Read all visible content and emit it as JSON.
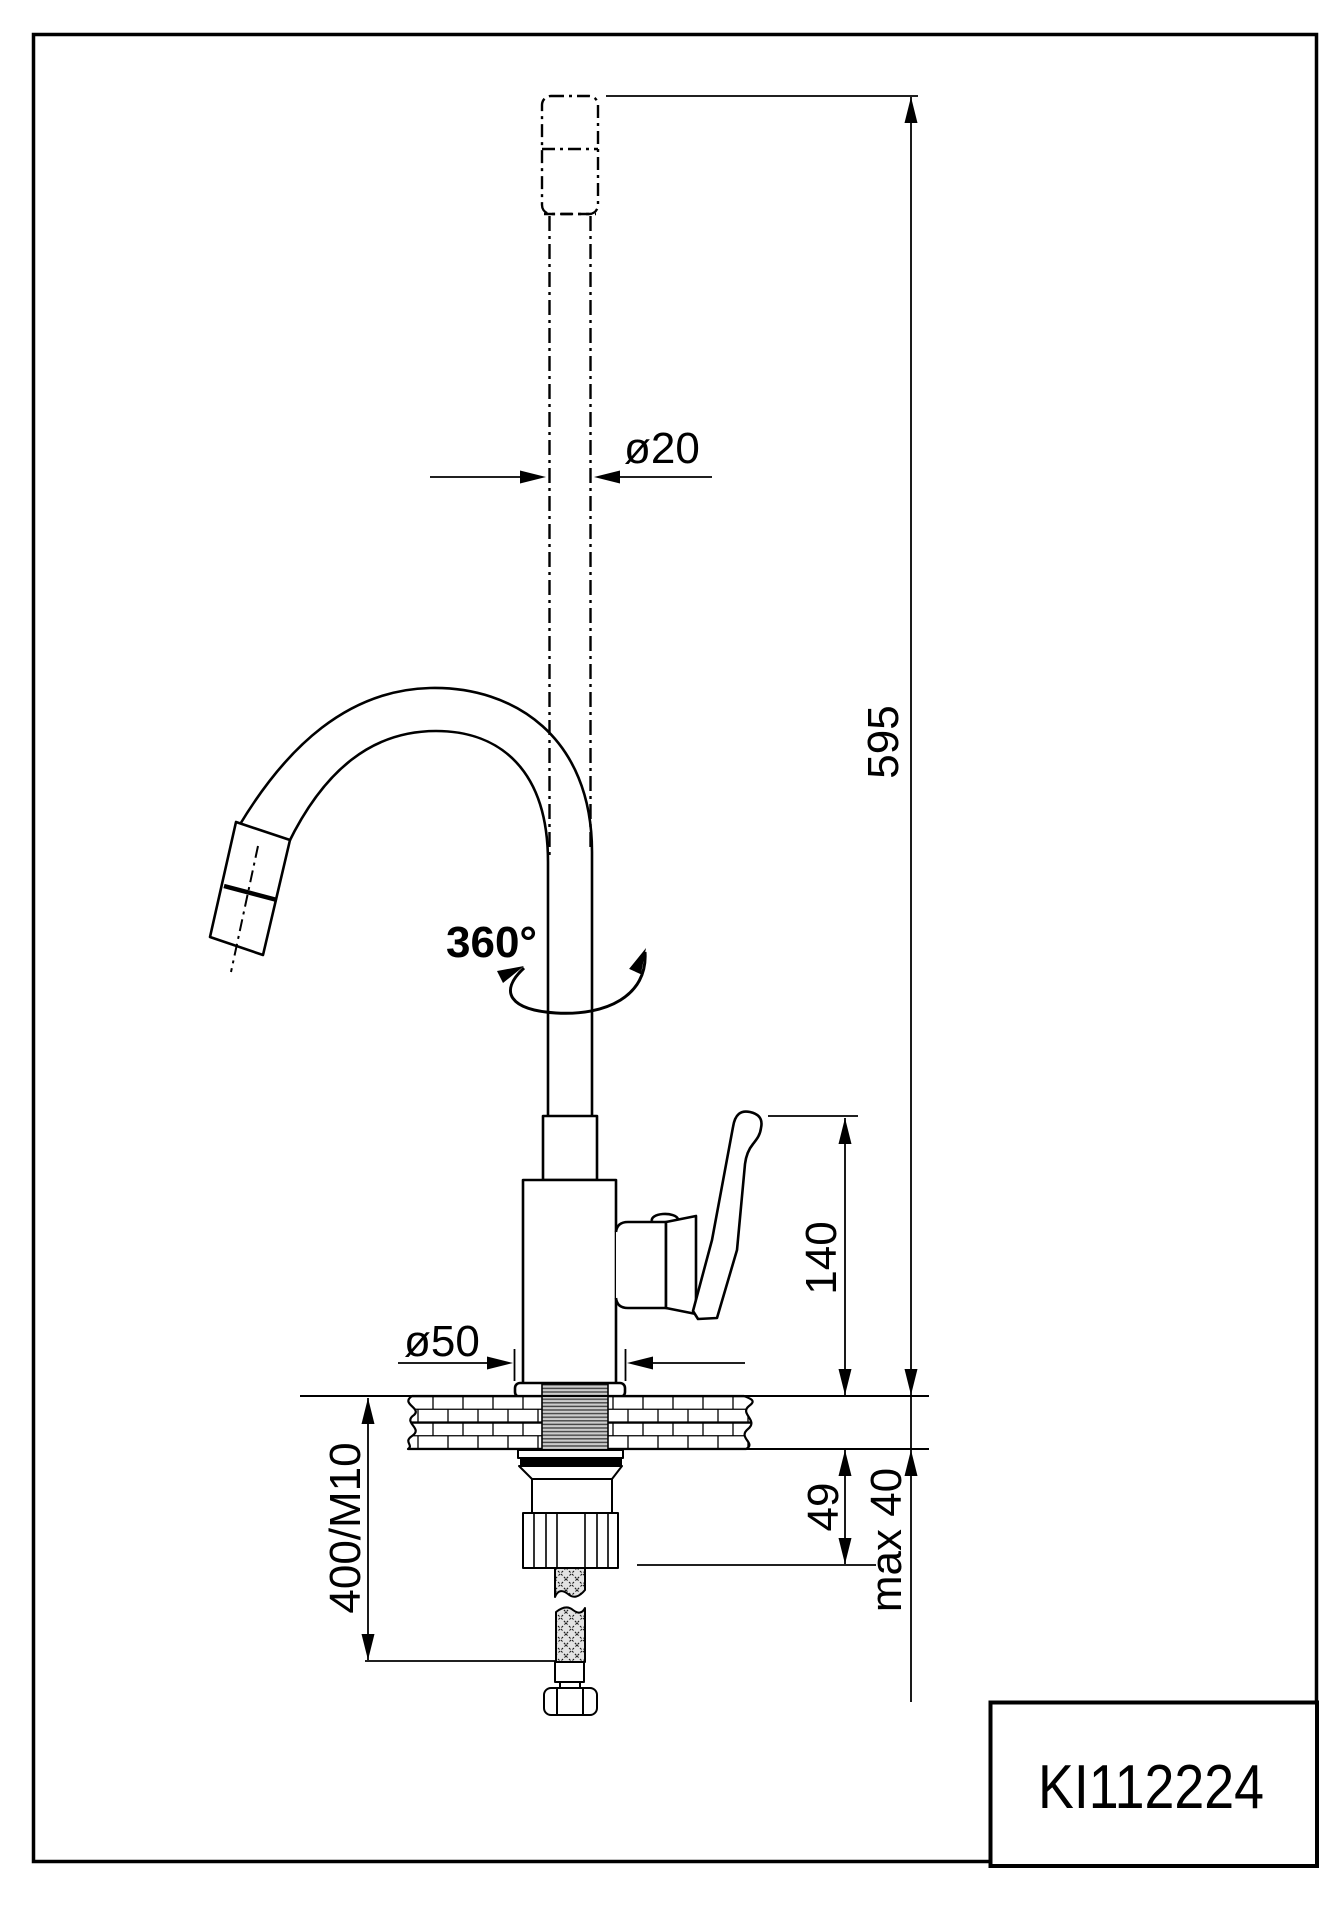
{
  "page": {
    "background": "#ffffff",
    "line_color": "#000000",
    "hatch_fill": "#e2e2e2",
    "thread_fill": "#cccccc"
  },
  "title_block": {
    "product_code": "KI112224"
  },
  "dimensions": {
    "spout_diameter": "ø20",
    "total_height": "595",
    "swivel_angle": "360°",
    "spout_outlet_height": "140",
    "base_diameter": "ø50",
    "hose_length_thread": "400/M10",
    "shank_length": "49",
    "max_mounting_thickness": "max 40"
  }
}
